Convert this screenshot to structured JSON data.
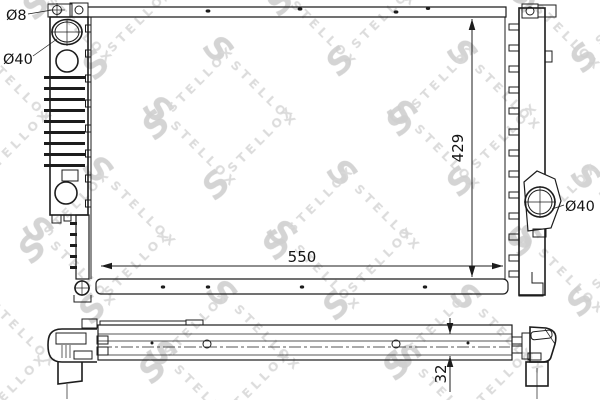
{
  "watermark": {
    "logo_letter": "S",
    "brand": "STELLOX",
    "color": "#d8d8d8"
  },
  "colors": {
    "line": "#1c1c1c",
    "background": "#ffffff"
  },
  "front_view": {
    "labels": {
      "mount_hole_diameter": "Ø8",
      "left_port_diameter": "Ø40",
      "core_height": "429",
      "core_width": "550",
      "right_port_diameter": "Ø40"
    }
  },
  "bottom_view": {
    "labels": {
      "core_thickness": "32"
    }
  }
}
